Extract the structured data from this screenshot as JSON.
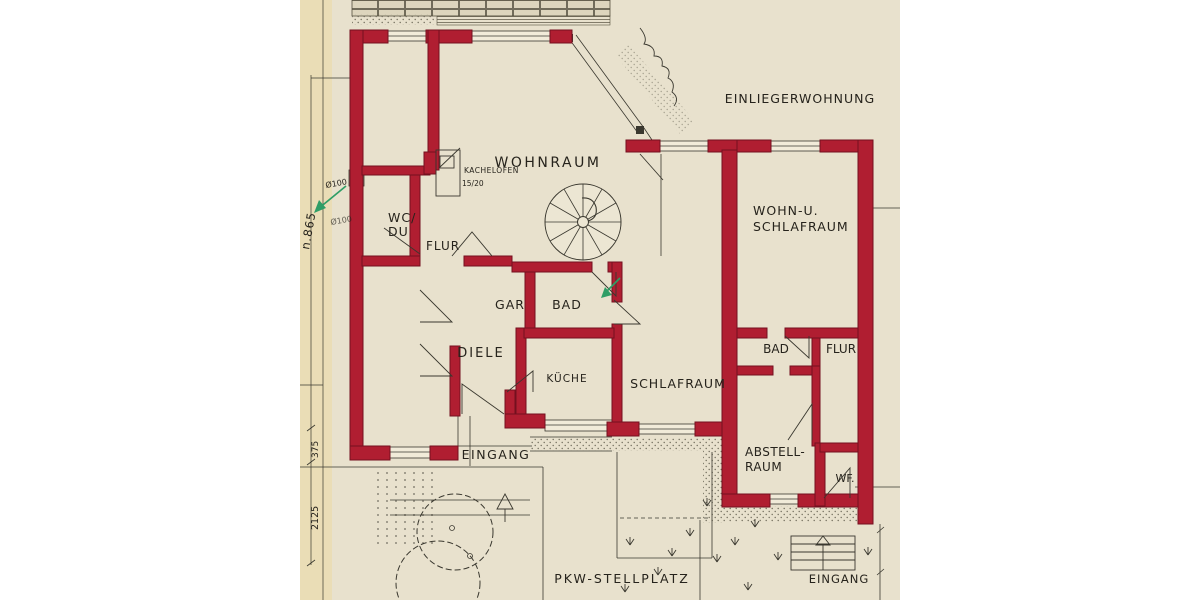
{
  "colors": {
    "wall": "#b01e31",
    "wall_outline": "#74101f",
    "paper": "#e8e1cd",
    "paper_edge": "#eaddb6",
    "ink": "#3a382f",
    "text": "#26231c",
    "arrow_green": "#2f9e66"
  },
  "labels": {
    "wohnraum": "WOHNRAUM",
    "kachelofen": "KACHELOFEN",
    "kachelofen_size": "15/20",
    "wc": "WC/",
    "du": "DU",
    "flur_main": "FLUR",
    "einliegerwohnung": "EINLIEGERWOHNUNG",
    "wohn_u": "WOHN-U.",
    "schlafraum_einlieger": "SCHLAFRAUM",
    "gar": "GAR",
    "bad_main": "BAD",
    "diele": "DIELE",
    "kueche": "KÜCHE",
    "schlafraum_main": "SCHLAFRAUM",
    "bad_einlieger": "BAD",
    "flur_einlieger": "FLUR",
    "abstell_line1": "ABSTELL-",
    "abstell_line2": "RAUM",
    "wf": "WF.",
    "eingang_main": "EINGANG",
    "eingang_einlieger": "EINGANG",
    "pkw_stellplatz": "PKW-STELLPLATZ"
  },
  "dimensions": {
    "total_height": "n.865",
    "pipe_1": "Ø100",
    "pipe_2": "Ø100",
    "dim_375": "375",
    "dim_2125": "2125"
  }
}
